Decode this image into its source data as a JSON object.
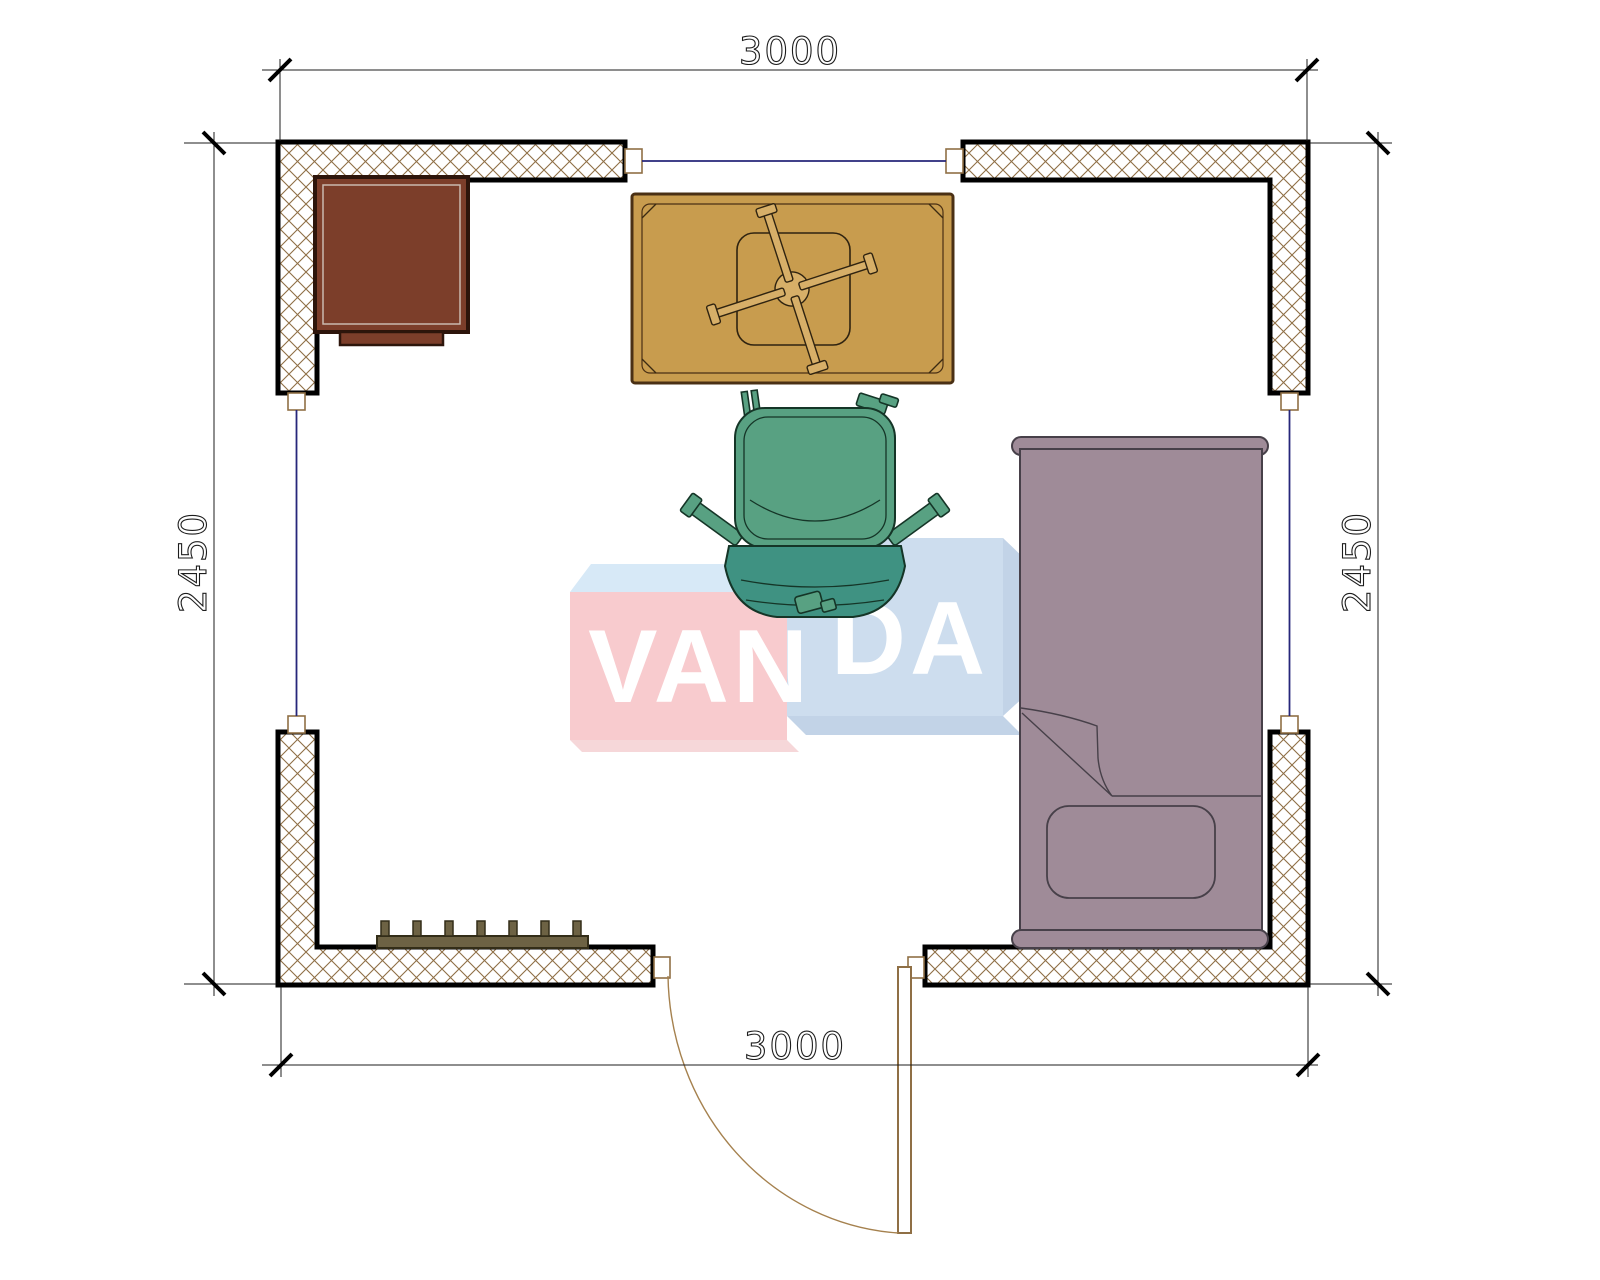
{
  "drawing": {
    "type": "floor-plan",
    "room_width_label": "3000",
    "room_depth_label": "2450"
  },
  "dimensions": {
    "top": "3000",
    "bottom": "3000",
    "left": "2450",
    "right": "2450"
  },
  "watermark": {
    "brand": "VANDA",
    "left_part": "VAN",
    "right_part": "DA"
  },
  "colors": {
    "wall_outline": "#000000",
    "wall_hatch": "#8f6f45",
    "window_line": "#26267a",
    "frame_brown": "#8f6f45",
    "dimension_ink": "#1d1d1d",
    "cabinet": "#7c3e2a",
    "cabinet_border": "#2d150b",
    "table": "#c89c4e",
    "table_border": "#4a3014",
    "chair_seat_green": "#58a182",
    "chair_back_green": "#3f9282",
    "bed_mauve": "#9f8b98",
    "bed_border": "#474049",
    "radiator": "#6d6244",
    "watermark_pink": "#f8cbce",
    "watermark_pink_light": "#f6d7d9",
    "watermark_blue": "#cdddee",
    "watermark_blue_side": "#c2d3e7",
    "watermark_top": "#d7e9f7",
    "watermark_text": "#ffffff"
  }
}
